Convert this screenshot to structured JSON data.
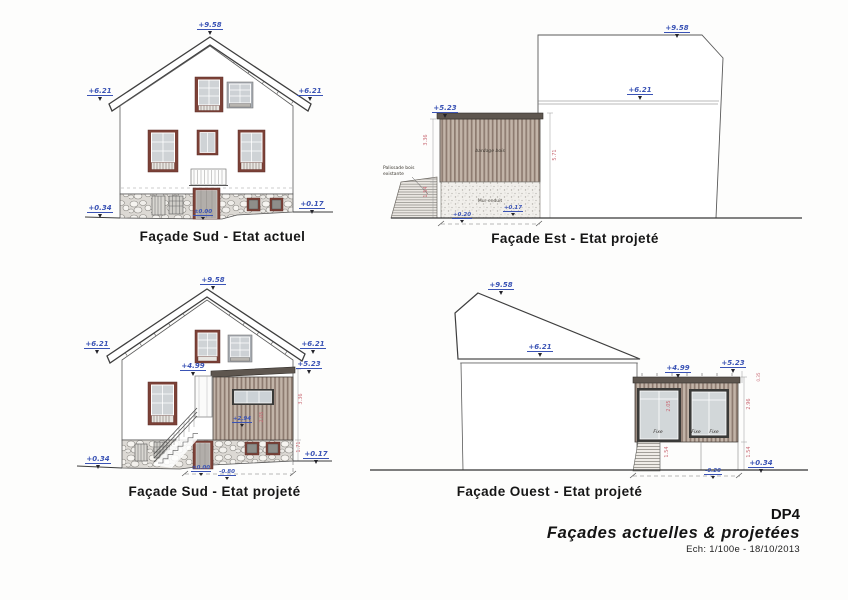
{
  "drawings": {
    "sud_actuel": {
      "title": "Façade Sud - Etat actuel",
      "dims": {
        "ridge": "+9.58",
        "eave_left": "+6.21",
        "eave_right": "+6.21",
        "ground_left": "+0.34",
        "ground_right": "+0.17",
        "door_sill": "±0.00"
      }
    },
    "est_projete": {
      "title": "Façade Est - Etat projeté",
      "dims": {
        "ridge": "+9.58",
        "eave": "+6.21",
        "extension_top": "+5.23",
        "base": "+0.17",
        "ground": "+0.20"
      },
      "labels": {
        "palissade_line1": "Palissade bois",
        "palissade_line2": "existante",
        "bardage": "bardage bois",
        "mur": "Mur enduit"
      },
      "red_dims": {
        "left_upper": "3.36",
        "left_lower": "1.54",
        "right": "5.71"
      }
    },
    "sud_projete": {
      "title": "Façade Sud - Etat projeté",
      "dims": {
        "ridge": "+9.58",
        "eave_left": "+6.21",
        "eave_right": "+6.21",
        "extension_top": "+5.23",
        "door_top": "+4.99",
        "landing": "+2.94",
        "ground_left": "+0.34",
        "ground_right": "+0.17",
        "door_sill": "±0.00",
        "pit": "-0.80"
      },
      "red_dims": {
        "right_upper": "3.36",
        "right_lower": "1.71",
        "window": "2.05"
      }
    },
    "ouest_projete": {
      "title": "Façade Ouest - Etat projeté",
      "dims": {
        "ridge": "+9.58",
        "eave": "+6.21",
        "door_top": "+4.99",
        "extension_top": "+5.23",
        "pit": "-0.20",
        "ground_right": "+0.34"
      },
      "window_labels": [
        "Fixe",
        "Fixe",
        "Fixe"
      ],
      "red_dims": {
        "right_upper": "2.96",
        "right_lower": "1.54",
        "left_lower": "1.54",
        "window": "2.05",
        "parapet": "0.35"
      }
    }
  },
  "title_block": {
    "code": "DP4",
    "title": "Façades actuelles & projetées",
    "scale_date": "Ech: 1/100e - 18/10/2013"
  },
  "colors": {
    "dim_blue": "#3a53b5",
    "dim_red": "#c96a74",
    "wood_dark": "#8d7b70",
    "wood_light": "#c2b4a8",
    "frame_brown": "#7c4137"
  }
}
